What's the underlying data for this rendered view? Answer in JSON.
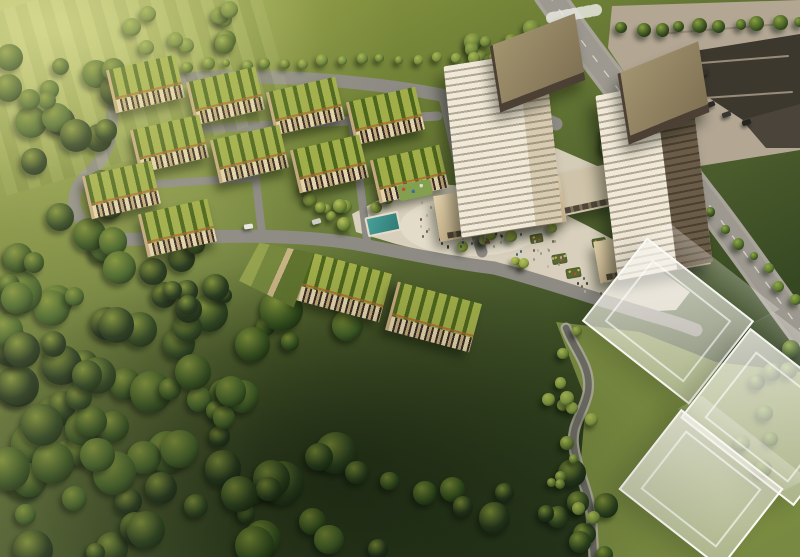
{
  "meta": {
    "description": "Aerial architectural rendering of a master-planned community: green-roof townhome blocks along looping streets, two balconied residential towers with a public plaza full of people, an amenity pool and playground, a parking lot and arterial road to the east, translucent future-phase building massing to the southeast, and dense parkland forest to the southwest."
  },
  "palette": {
    "grass_hi": "#a8b25c",
    "grass_mid": "#74863e",
    "grass_dark": "#31431f",
    "forest": "#243520",
    "road": "#8d8b84",
    "road_hi": "#a8a49a",
    "road_dark": "#6f6d66",
    "plaza": "#d8d0bc",
    "plaza_hi": "#e7e0cd",
    "parking": "#b3a794",
    "roof_ne": "#3d382e",
    "roof_g1": "#4d661d",
    "roof_g2": "#a0ad49",
    "fac1": "#e3d2ab",
    "fac2": "#372f25",
    "fac3": "#c3a97d",
    "fac_orange": "#b0622f",
    "tower_w": "#f0e9da",
    "tower_band": "#b2a791",
    "tower_glass": "#584a39",
    "bronze_hi": "#a3946f",
    "bronze": "#807154",
    "bronze_dark": "#4b4033",
    "pool": "#3f8e89",
    "water": "#27404d",
    "ghost": "#f2f0e8"
  },
  "scene": {
    "areas": [
      {
        "name": "podium-garden",
        "pts": "330,196 402,176 452,186 470,216 430,238 352,238",
        "fill": "#6f8240"
      },
      {
        "name": "lawn-east",
        "pts": "556,322 640,332 716,362 800,372 800,557 590,557 580,470 586,400",
        "fill": "#7d8f43",
        "op": 0.95
      },
      {
        "name": "parking-lot",
        "pts": "612,6 800,0 800,150 700,166 648,108 608,48",
        "fill": "#b3a794"
      },
      {
        "name": "roofs-northeast",
        "pts": "688,52 800,34 800,118 752,126 700,92",
        "fill": "#3d382e"
      },
      {
        "name": "roofs-northeast-2",
        "pts": "742,120 800,104 800,148 766,148",
        "fill": "#4a443b"
      },
      {
        "name": "plaza",
        "pts": "352,214 390,194 438,184 492,188 540,202 588,226 636,252 668,276 690,292 676,310 640,312 588,300 520,278 452,258 396,244 356,232",
        "fill": "#d8d0bc"
      },
      {
        "name": "plaza-highlight",
        "ellipse": [
          472,
          226,
          72,
          30
        ],
        "fill": "#e7e0cd",
        "op": 0.75
      },
      {
        "name": "upper-plaza-finger",
        "pts": "516,168 556,148 602,168 612,198 572,212 528,196",
        "fill": "#d5ccb7"
      },
      {
        "name": "tower-water-feature",
        "pts": "556,182 596,178 600,190 560,194",
        "fill": "#27404d"
      }
    ],
    "roads": [
      {
        "name": "ring-north",
        "d": "M 116 88 C 210 68 350 78 436 94 C 492 104 528 112 556 124",
        "w": 13
      },
      {
        "name": "ring-west",
        "d": "M 116 88 C 108 124 118 148 88 174 C 62 198 74 228 114 240",
        "w": 12
      },
      {
        "name": "ring-south",
        "d": "M 114 240 C 210 236 296 232 368 246 C 430 258 462 264 494 268",
        "w": 13
      },
      {
        "name": "street-mid-a",
        "d": "M 146 132 L 438 116",
        "w": 9
      },
      {
        "name": "street-mid-b",
        "d": "M 124 186 L 250 178",
        "w": 8
      },
      {
        "name": "street-vert-1",
        "d": "M 250 128 L 262 234",
        "w": 8
      },
      {
        "name": "street-vert-2",
        "d": "M 352 120 L 368 248",
        "w": 8
      },
      {
        "name": "street-east-edge",
        "d": "M 444 98 C 456 142 462 192 482 252",
        "w": 11
      },
      {
        "name": "south-access-road",
        "d": "M 494 268 C 548 282 604 302 660 318 C 674 322 686 326 696 330",
        "w": 13
      },
      {
        "name": "parking-aisle-1",
        "d": "M 658 34 L 782 24",
        "w": 2,
        "c": "#978c79"
      },
      {
        "name": "parking-aisle-2",
        "d": "M 664 66 L 788 56",
        "w": 2,
        "c": "#978c79"
      },
      {
        "name": "parking-aisle-3",
        "d": "M 674 100 L 792 92",
        "w": 2,
        "c": "#978c79"
      },
      {
        "name": "main-street-shoulder",
        "d": "M 548 -6 C 576 34 606 74 650 130 C 680 168 692 182 702 196 C 728 228 762 278 802 332",
        "w": 30,
        "c": "#a8a49a"
      },
      {
        "name": "main-street",
        "d": "M 548 -6 C 576 34 606 74 650 130 C 680 168 692 182 702 196 C 728 228 762 278 802 332",
        "w": 23,
        "c": "#9d9990",
        "dash": true
      },
      {
        "name": "crosswalk",
        "d": "M 552 18 L 596 10",
        "w": 12,
        "c": "#e8e6e0",
        "dasharray": "3 4",
        "op": 0.85
      },
      {
        "name": "greenway-path-curb",
        "d": "M 566 328 C 574 350 592 366 588 392 C 584 414 570 424 574 448 C 578 474 590 492 592 522 L 594 560",
        "w": 11,
        "c": "#b7b2a6",
        "op": 0.85
      },
      {
        "name": "greenway-path",
        "d": "M 566 328 C 574 350 592 366 588 392 C 584 414 570 424 574 448 C 578 474 590 492 592 522 L 594 560",
        "w": 6.5,
        "c": "#6e6d66"
      }
    ],
    "townhouse_blocks": [
      [
        110,
        62,
        68,
        44,
        -13
      ],
      [
        190,
        74,
        68,
        44,
        -13
      ],
      [
        270,
        84,
        68,
        44,
        -13
      ],
      [
        350,
        94,
        68,
        44,
        -13
      ],
      [
        134,
        122,
        68,
        44,
        -13
      ],
      [
        214,
        132,
        68,
        44,
        -13
      ],
      [
        294,
        142,
        68,
        44,
        -13
      ],
      [
        374,
        152,
        68,
        44,
        -13
      ],
      [
        86,
        168,
        68,
        44,
        -13
      ],
      [
        142,
        206,
        68,
        44,
        -13
      ],
      [
        300,
        262,
        84,
        50,
        15
      ],
      [
        390,
        292,
        84,
        50,
        15
      ]
    ],
    "towers": [
      {
        "name": "tower-west",
        "podium": [
          436,
          186,
          128,
          46,
          -9
        ],
        "shaft": [
          452,
          58,
          102,
          172,
          -6,
          -3
        ],
        "side_w": 26,
        "side": "cream",
        "roof": [
          492,
          30,
          88,
          58,
          -21,
          -12
        ]
      },
      {
        "name": "tower-east",
        "podium": [
          596,
          232,
          112,
          42,
          -10
        ],
        "shaft": [
          606,
          86,
          96,
          186,
          -7,
          -4
        ],
        "side_w": 38,
        "side": "glass",
        "roof": [
          620,
          58,
          84,
          62,
          -22,
          -13
        ]
      }
    ],
    "bridge": [
      548,
      170,
      66,
      42,
      -12
    ],
    "ghost_blocks": [
      [
        600,
        268,
        132,
        102,
        38
      ],
      [
        700,
        360,
        140,
        110,
        38
      ],
      [
        636,
        438,
        126,
        98,
        38
      ]
    ],
    "tree_regions": [
      {
        "name": "forest-southwest",
        "x": 0,
        "y": 290,
        "w": 350,
        "h": 265,
        "n": 85,
        "rmin": 9,
        "rmax": 22,
        "seed": 11,
        "pal": [
          "#24371c",
          "#2c431f",
          "#35511f",
          "#415f27"
        ],
        "hi": "#7e9038",
        "sh": "#101c0b"
      },
      {
        "name": "forest-west-band",
        "x": 0,
        "y": 55,
        "w": 125,
        "h": 245,
        "n": 32,
        "rmin": 8,
        "rmax": 17,
        "seed": 22,
        "pal": [
          "#24371c",
          "#2c431f",
          "#35511f",
          "#415f27"
        ],
        "hi": "#7e9038",
        "sh": "#101c0b"
      },
      {
        "name": "hill-north",
        "x": 118,
        "y": 0,
        "w": 120,
        "h": 52,
        "n": 10,
        "rmin": 6,
        "rmax": 11,
        "seed": 33,
        "pal": [
          "#4c6426",
          "#5a732c",
          "#6b823a"
        ],
        "hi": "#9aab4e",
        "sh": "#1c290f"
      },
      {
        "name": "gap-west",
        "x": 150,
        "y": 238,
        "w": 125,
        "h": 75,
        "n": 10,
        "rmin": 7,
        "rmax": 14,
        "seed": 44,
        "pal": [
          "#24371c",
          "#2c431f",
          "#35511f"
        ],
        "hi": "#7e9038",
        "sh": "#101c0b"
      },
      {
        "name": "bottom-middle",
        "x": 340,
        "y": 470,
        "w": 330,
        "h": 85,
        "n": 16,
        "rmin": 8,
        "rmax": 16,
        "seed": 55,
        "pal": [
          "#24371c",
          "#2c431f",
          "#35511f"
        ],
        "hi": "#7e9038",
        "sh": "#101c0b"
      },
      {
        "name": "east-grove",
        "x": 596,
        "y": 116,
        "w": 112,
        "h": 84,
        "n": 12,
        "rmin": 5,
        "rmax": 9,
        "seed": 66,
        "pal": [
          "#3c5524",
          "#4c6828",
          "#5e7a30"
        ],
        "hi": "#8fa845",
        "sh": "#16220f"
      },
      {
        "name": "greenway-right",
        "x": 742,
        "y": 348,
        "w": 56,
        "h": 130,
        "n": 8,
        "rmin": 6,
        "rmax": 10,
        "seed": 77,
        "pal": [
          "#3c5524",
          "#4c6828",
          "#5e7a30"
        ],
        "hi": "#8fa845",
        "sh": "#16220f"
      },
      {
        "name": "plaza-bosque",
        "x": 455,
        "y": 226,
        "w": 105,
        "h": 54,
        "n": 9,
        "rmin": 4,
        "rmax": 7,
        "seed": 88,
        "pal": [
          "#6d8434",
          "#7e9439",
          "#8fa13f"
        ],
        "hi": "#b5c25c",
        "sh": "#2a3a14"
      },
      {
        "name": "path-trees",
        "x": 548,
        "y": 330,
        "w": 46,
        "h": 205,
        "n": 15,
        "rmin": 4,
        "rmax": 7,
        "seed": 99,
        "pal": [
          "#5e7630",
          "#6f8738",
          "#7f9740"
        ],
        "hi": "#adbc56",
        "sh": "#22300f"
      },
      {
        "name": "pool-garden-trees",
        "x": 328,
        "y": 190,
        "w": 62,
        "h": 48,
        "n": 6,
        "rmin": 4,
        "rmax": 7,
        "seed": 111,
        "pal": [
          "#6d8434",
          "#7e9439",
          "#8fa13f"
        ],
        "hi": "#b5c25c",
        "sh": "#2a3a14"
      },
      {
        "name": "tower-backdrop",
        "x": 452,
        "y": 28,
        "w": 100,
        "h": 82,
        "n": 10,
        "rmin": 5,
        "rmax": 9,
        "seed": 122,
        "pal": [
          "#4c6426",
          "#5a732c",
          "#6b823a"
        ],
        "hi": "#9aab4e",
        "sh": "#1c290f"
      },
      {
        "name": "plaza-west-slope",
        "x": 298,
        "y": 178,
        "w": 42,
        "h": 62,
        "n": 5,
        "rmin": 4,
        "rmax": 7,
        "seed": 133,
        "pal": [
          "#6d8434",
          "#7e9439",
          "#8fa13f"
        ],
        "hi": "#b5c25c",
        "sh": "#2a3a14"
      }
    ],
    "tree_rows": [
      {
        "name": "north-hedge-row",
        "x1": 188,
        "y1": 66,
        "x2": 552,
        "y2": 54,
        "n": 20,
        "rmin": 4,
        "rmax": 7,
        "jit": 4,
        "seed": 7,
        "pal": [
          "#5a732c",
          "#6b823a",
          "#7d9240"
        ],
        "hi": "#a7b654",
        "sh": "#1c290f"
      },
      {
        "name": "parking-tree-row",
        "x1": 622,
        "y1": 30,
        "x2": 798,
        "y2": 20,
        "n": 10,
        "rmin": 5,
        "rmax": 8,
        "jit": 5,
        "seed": 8,
        "pal": [
          "#3a5220",
          "#466026",
          "#54702c"
        ],
        "hi": "#87a03e",
        "sh": "#141f0c"
      },
      {
        "name": "arterial-tree-row",
        "x1": 700,
        "y1": 198,
        "x2": 795,
        "y2": 300,
        "n": 8,
        "rmin": 4,
        "rmax": 6,
        "jit": 6,
        "seed": 9,
        "pal": [
          "#3c5524",
          "#4c6828",
          "#5e7a30"
        ],
        "hi": "#8fa845",
        "sh": "#16220f"
      }
    ],
    "people_clusters": [
      {
        "name": "plaza-crowd",
        "cx": 468,
        "cy": 224,
        "rx": 58,
        "ry": 24,
        "n": 55,
        "seed": 3
      },
      {
        "name": "east-walk-crowd",
        "cx": 545,
        "cy": 252,
        "rx": 30,
        "ry": 16,
        "n": 18,
        "seed": 4
      },
      {
        "name": "south-walk-crowd",
        "cx": 598,
        "cy": 282,
        "rx": 26,
        "ry": 12,
        "n": 10,
        "seed": 5
      },
      {
        "name": "upper-plaza-crowd",
        "cx": 436,
        "cy": 200,
        "rx": 20,
        "ry": 8,
        "n": 8,
        "seed": 6
      }
    ],
    "people_colors": [
      "#32302c",
      "#6e5a48",
      "#9b9488",
      "#b8b2a6",
      "#7a3f34",
      "#3d5a78"
    ],
    "props": [
      {
        "t": "pool",
        "name": "amenity-pool",
        "x": 366,
        "y": 214,
        "w": 30,
        "h": 16,
        "rot": -12
      },
      {
        "t": "playground",
        "name": "playground",
        "x": 398,
        "y": 182,
        "w": 34,
        "h": 16,
        "rot": -12
      },
      {
        "t": "planter",
        "name": "flower-planter",
        "x": 552,
        "y": 254,
        "w": 15,
        "h": 10,
        "rot": -10
      },
      {
        "t": "planter",
        "name": "flower-planter",
        "x": 566,
        "y": 268,
        "w": 15,
        "h": 10,
        "rot": -10
      },
      {
        "t": "planter",
        "name": "flower-planter",
        "x": 592,
        "y": 238,
        "w": 14,
        "h": 9,
        "rot": -10
      },
      {
        "t": "planter",
        "name": "flower-planter",
        "x": 530,
        "y": 234,
        "w": 13,
        "h": 9,
        "rot": -10
      },
      {
        "t": "terrace",
        "name": "terraced-garden-building",
        "x": 242,
        "y": 244,
        "w": 66,
        "h": 58,
        "rot": 14
      },
      {
        "t": "car",
        "name": "car-white",
        "x": 244,
        "y": 224,
        "rot": -8,
        "c": "#e8e6e0"
      },
      {
        "t": "car",
        "name": "car-silver",
        "x": 312,
        "y": 219,
        "rot": -16,
        "c": "#cfcdc7"
      },
      {
        "t": "car",
        "name": "parked-car",
        "x": 706,
        "y": 102,
        "rot": -20,
        "c": "#2e2b27"
      },
      {
        "t": "car",
        "name": "parked-car",
        "x": 722,
        "y": 112,
        "rot": -20,
        "c": "#3a3733"
      },
      {
        "t": "car",
        "name": "parked-car",
        "x": 742,
        "y": 120,
        "rot": -20,
        "c": "#262420"
      },
      {
        "t": "car",
        "name": "parked-car",
        "x": 700,
        "y": 70,
        "rot": -18,
        "c": "#35322d"
      }
    ]
  }
}
